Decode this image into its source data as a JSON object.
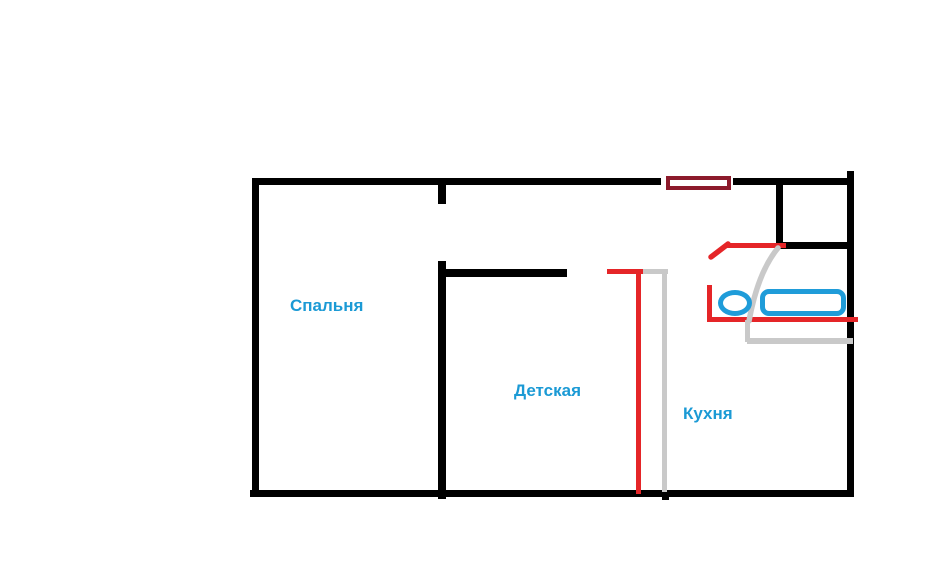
{
  "canvas": {
    "width_px": 949,
    "height_px": 564,
    "background": "#ffffff"
  },
  "rooms": {
    "bedroom": "Спальня",
    "kids_room": "Детская",
    "kitchen": "Кухня"
  },
  "colors": {
    "wall": "#000000",
    "annotation_red": "#e52528",
    "annotation_gray": "#c9c9c9",
    "fixture_blue": "#1f9cd9",
    "window_maroon": "#8c1a2b",
    "label_blue": "#1b9ad5"
  },
  "icons": {
    "toilet": "blue ellipse outline",
    "bathtub": "blue rounded-rectangle outline",
    "window_vent": "maroon filled rectangle with white slot",
    "door_swing": "gray quarter arc",
    "door_leaf": "red diagonal stroke"
  }
}
